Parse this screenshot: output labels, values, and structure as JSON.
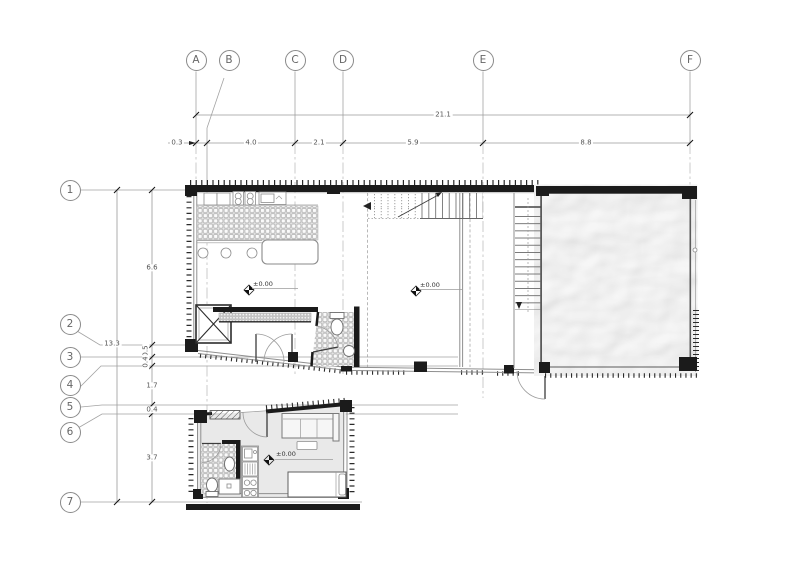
{
  "drawing": {
    "title": "floor-plan",
    "grid_columns": [
      "A",
      "B",
      "C",
      "D",
      "E",
      "F"
    ],
    "grid_rows": [
      "1",
      "2",
      "3",
      "4",
      "5",
      "6",
      "7"
    ],
    "dims": {
      "h_total": "21.1",
      "h_segs": [
        "0.3",
        "4.0",
        "2.1",
        "5.9",
        "8.8"
      ],
      "v_total": "13.3",
      "v_segs": [
        "6.6",
        "0.5",
        "0.4",
        "1.7",
        "0.4",
        "3.7"
      ]
    },
    "level_markers": [
      "±0.00",
      "±0.00",
      "±0.00"
    ],
    "colors": {
      "wall": "#1b1b1b",
      "line": "#8a8a8a",
      "pool_water": "#bdbdbd",
      "annex_floor": "#e9e9e9",
      "tile_line": "#b0b0b0",
      "text": "#555555",
      "paper": "#ffffff"
    }
  }
}
